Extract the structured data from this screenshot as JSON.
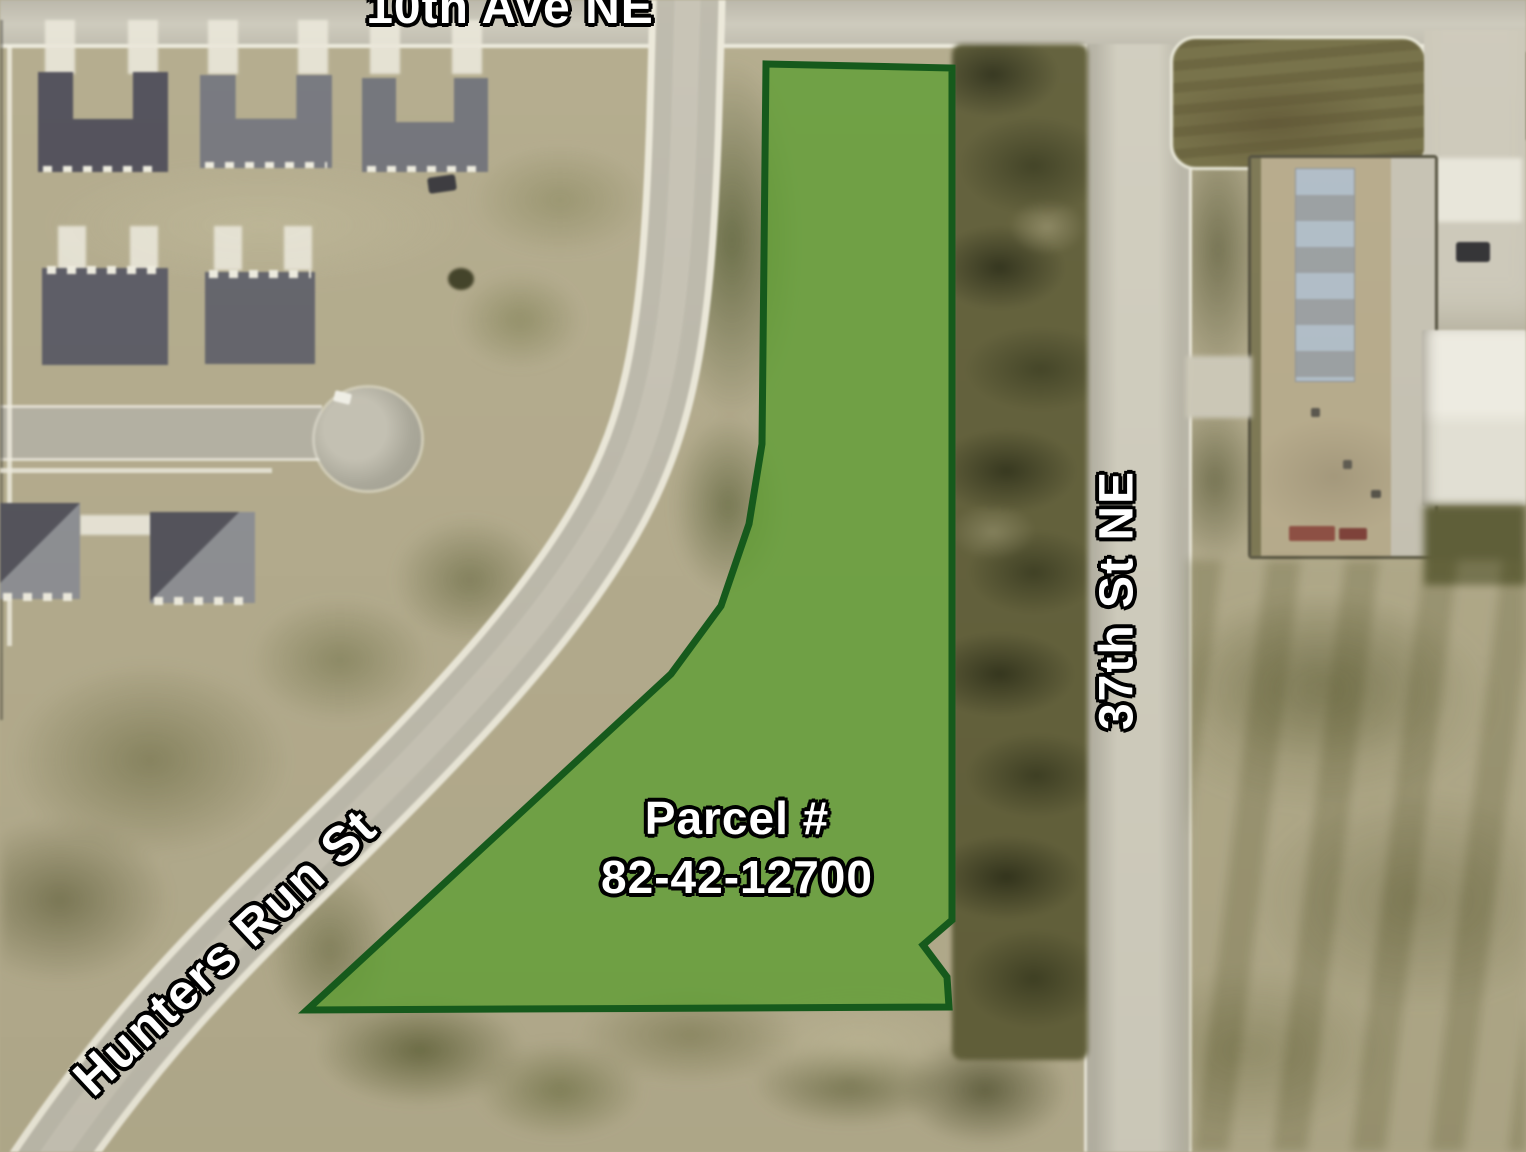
{
  "map": {
    "labels": {
      "top_street": "10th Ave NE",
      "right_street": "37th St NE",
      "diagonal_street": "Hunters Run St",
      "parcel_label_line1": "Parcel #",
      "parcel_label_line2": "82-42-12700"
    },
    "parcel": {
      "number": "82-42-12700"
    },
    "colors": {
      "parcel_fill": "#5f9e33",
      "parcel_border": "#165a1c",
      "label_text": "#ffffff",
      "label_outline": "#000000"
    }
  }
}
